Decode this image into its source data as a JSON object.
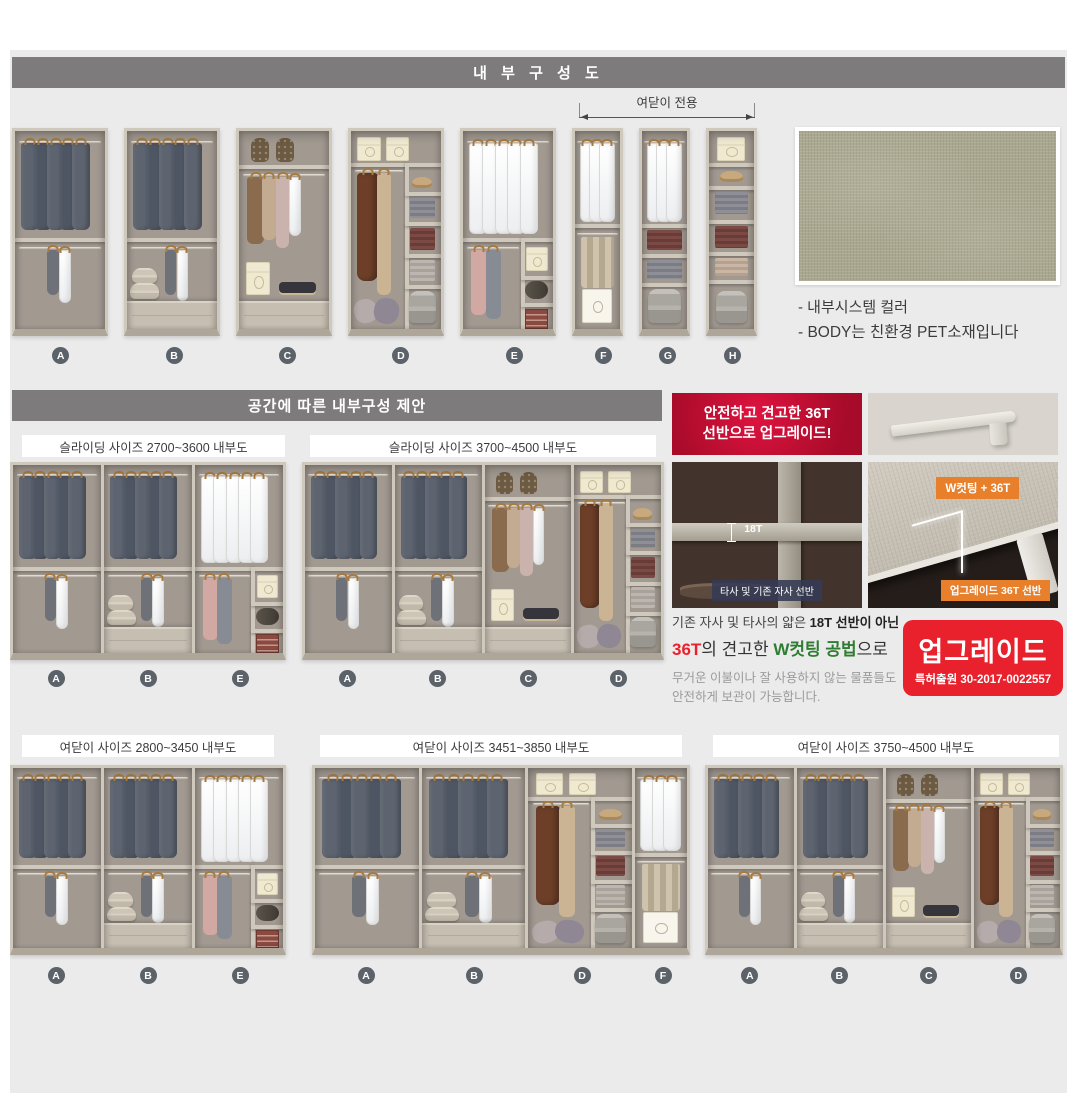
{
  "page": {
    "header1": "내 부 구 성 도",
    "header2": "공간에 따른 내부구성 제안"
  },
  "top_row": {
    "bracket_label": "여닫이 전용",
    "units": [
      "A",
      "B",
      "C",
      "D",
      "E",
      "F",
      "G",
      "H"
    ]
  },
  "swatch": {
    "caption1": "- 내부시스템 컬러",
    "caption2": "- BODY는 친환경 PET소재입니다",
    "color": "#a9a78f"
  },
  "sections": {
    "sliding1": {
      "title": "슬라이딩 사이즈 2700~3600 내부도",
      "units": [
        "A",
        "B",
        "E"
      ]
    },
    "sliding2": {
      "title": "슬라이딩 사이즈 3700~4500 내부도",
      "units": [
        "A",
        "B",
        "C",
        "D"
      ]
    },
    "hinged1": {
      "title": "여닫이 사이즈 2800~3450 내부도",
      "units": [
        "A",
        "B",
        "E"
      ]
    },
    "hinged2": {
      "title": "여닫이 사이즈 3451~3850 내부도",
      "units": [
        "A",
        "B",
        "D",
        "F"
      ]
    },
    "hinged3": {
      "title": "여닫이 사이즈 3750~4500 내부도",
      "units": [
        "A",
        "B",
        "C",
        "D"
      ]
    }
  },
  "upgrade": {
    "badge_line1": "안전하고 견고한 36T",
    "badge_line2": "선반으로 업그레이드!",
    "old_label": "18T",
    "old_caption": "타사 및 기존 자사 선반",
    "new_badge": "W컷팅 + 36T",
    "new_caption": "업그레이드 36T 선반",
    "desc_line1_a": "기존 자사 및 타사의 얇은 ",
    "desc_line1_b": "18T 선반이 아닌",
    "desc_line2_a": "36T",
    "desc_line2_b": "의 견고한 ",
    "desc_line2_c": "W컷팅 공법",
    "desc_line2_d": "으로",
    "desc_small1": "무거운 이불이나 잘 사용하지 않는 물품들도",
    "desc_small2": "안전하게 보관이 가능합니다.",
    "stamp_title": "업그레이드",
    "stamp_sub": "특허출원 30-2017-0022557",
    "accent_red": "#e8212d",
    "accent_orange": "#e87f2b",
    "accent_green": "#2f7d32"
  }
}
